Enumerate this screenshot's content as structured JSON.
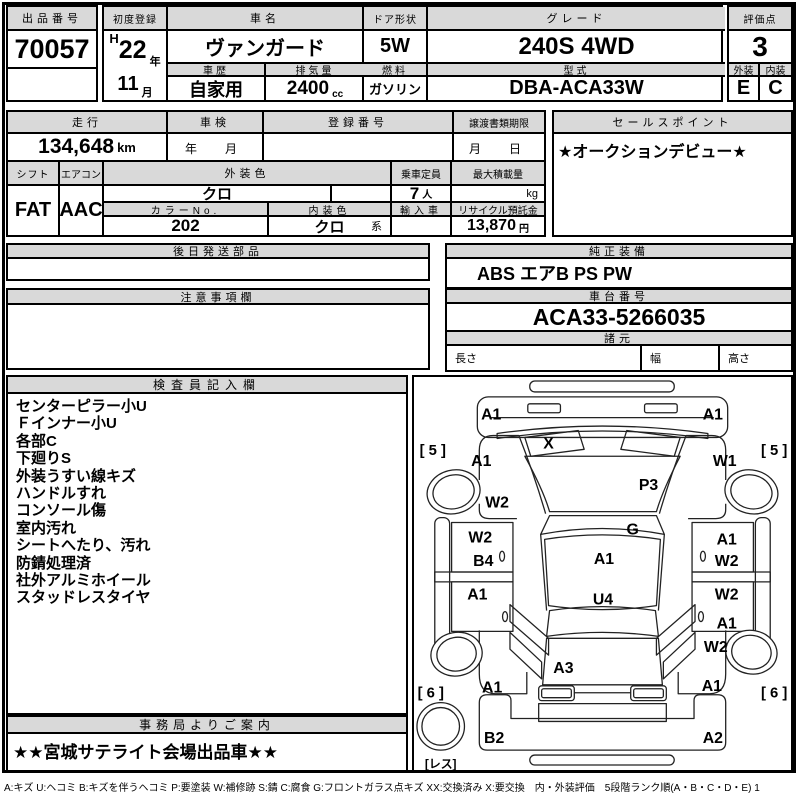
{
  "colors": {
    "header_bg": "#d9d9d9",
    "border": "#000000",
    "background": "#ffffff"
  },
  "header": {
    "lot_no_label": "出品番号",
    "lot_no": "70057",
    "first_reg_label": "初度登録",
    "era": "H",
    "year": "22",
    "year_unit": "年",
    "month": "11",
    "month_unit": "月",
    "car_name_label": "車名",
    "car_name": "ヴァンガード",
    "history_label": "車歴",
    "history": "自家用",
    "displacement_label": "排気量",
    "displacement": "2400",
    "displacement_unit": "cc",
    "door_label": "ドア形状",
    "door": "5W",
    "fuel_label": "燃料",
    "fuel": "ガソリン",
    "grade_label": "グレード",
    "grade": "240S 4WD",
    "model_code_label": "型式",
    "model_code": "DBA-ACA33W",
    "score_label": "評価点",
    "score": "3",
    "exterior_label": "外装",
    "exterior": "E",
    "interior_label": "内装",
    "interior": "C"
  },
  "info": {
    "mileage_label": "走行",
    "mileage": "134,648",
    "mileage_unit": "km",
    "inspection_label": "車検",
    "inspection_placeholder": "年　月",
    "reg_no_label": "登録番号",
    "transfer_label": "譲渡書類期限",
    "transfer_placeholder": "月　日",
    "sales_point_label": "セールスポイント",
    "sales_point": "★オークションデビュー★",
    "shift_label": "シフト",
    "shift": "FAT",
    "aircon_label": "エアコン",
    "aircon": "AAC",
    "ext_color_label": "外装色",
    "ext_color": "クロ",
    "capacity_label": "乗車定員",
    "capacity": "7",
    "capacity_unit": "人",
    "max_load_label": "最大積載量",
    "max_load_unit": "kg",
    "color_no_label": "カラーNo.",
    "color_no": "202",
    "int_color_label": "内装色",
    "int_color": "クロ",
    "int_color_suffix": "系",
    "import_label": "輸入車",
    "recycle_label": "リサイクル預託金",
    "recycle_fee": "13,870",
    "recycle_unit": "円"
  },
  "sections": {
    "later_parts_label": "後日発送部品",
    "equipment_label": "純正装備",
    "equipment": "ABS エアB PS PW",
    "notes_label": "注意事項欄",
    "chassis_label": "車台番号",
    "chassis_no": "ACA33-5266035",
    "specs_label": "諸元",
    "length_label": "長さ",
    "width_label": "幅",
    "height_label": "高さ",
    "inspector_label": "検査員記入欄",
    "inspector_notes": [
      "センターピラー小U",
      "Ｆインナー小U",
      "各部C",
      "下廻りS",
      "外装うすい線キズ",
      "ハンドルすれ",
      "コンソール傷",
      "室内汚れ",
      "シートへたり、汚れ",
      "防錆処理済",
      "社外アルミホイール",
      "スタッドレスタイヤ"
    ],
    "office_label": "事務局よりご案内",
    "office_note": "★★宮城サテライト会場出品車★★"
  },
  "diagram": {
    "markers": [
      {
        "code": "A1",
        "x": 78,
        "y": 37
      },
      {
        "code": "A1",
        "x": 302,
        "y": 37
      },
      {
        "code": "X",
        "x": 136,
        "y": 66
      },
      {
        "code": "[ 5 ]",
        "x": 19,
        "y": 73
      },
      {
        "code": "[ 5 ]",
        "x": 364,
        "y": 73
      },
      {
        "code": "A1",
        "x": 68,
        "y": 84
      },
      {
        "code": "W1",
        "x": 314,
        "y": 84
      },
      {
        "code": "P3",
        "x": 237,
        "y": 108
      },
      {
        "code": "W2",
        "x": 84,
        "y": 126
      },
      {
        "code": "G",
        "x": 221,
        "y": 153
      },
      {
        "code": "W2",
        "x": 67,
        "y": 161
      },
      {
        "code": "B4",
        "x": 70,
        "y": 185
      },
      {
        "code": "A1",
        "x": 316,
        "y": 163
      },
      {
        "code": "W2",
        "x": 316,
        "y": 185
      },
      {
        "code": "A1",
        "x": 192,
        "y": 183
      },
      {
        "code": "U4",
        "x": 191,
        "y": 224
      },
      {
        "code": "A1",
        "x": 64,
        "y": 219
      },
      {
        "code": "W2",
        "x": 316,
        "y": 219
      },
      {
        "code": "A1",
        "x": 316,
        "y": 248
      },
      {
        "code": "W2",
        "x": 305,
        "y": 272
      },
      {
        "code": "A3",
        "x": 151,
        "y": 293
      },
      {
        "code": "A1",
        "x": 79,
        "y": 313
      },
      {
        "code": "A1",
        "x": 301,
        "y": 311
      },
      {
        "code": "[ 6 ]",
        "x": 17,
        "y": 318
      },
      {
        "code": "[ 6 ]",
        "x": 364,
        "y": 318
      },
      {
        "code": "B2",
        "x": 81,
        "y": 364
      },
      {
        "code": "A2",
        "x": 302,
        "y": 364
      },
      {
        "code": "[レス]",
        "x": 27,
        "y": 389
      }
    ]
  },
  "legend": "A:キズ U:ヘコミ B:キズを伴うヘコミ P:要塗装 W:補修跡 S:錆 C:腐食 G:フロントガラス点キズ XX:交換済み X:要交換　内・外装評価　5段階ランク順(A・B・C・D・E) 1"
}
